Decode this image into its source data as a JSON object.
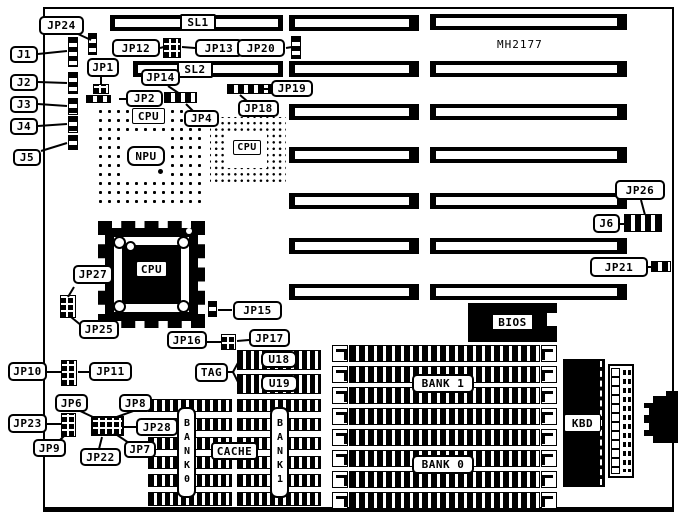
{
  "board": {
    "model": "MH2177"
  },
  "slots": {
    "sl1": "SL1",
    "sl2": "SL2"
  },
  "connectors": {
    "j1": "J1",
    "j2": "J2",
    "j3": "J3",
    "j4": "J4",
    "j5": "J5",
    "j6": "J6"
  },
  "jumpers": {
    "jp1": "JP1",
    "jp2": "JP2",
    "jp4": "JP4",
    "jp6": "JP6",
    "jp7": "JP7",
    "jp8": "JP8",
    "jp9": "JP9",
    "jp10": "JP10",
    "jp11": "JP11",
    "jp12": "JP12",
    "jp13": "JP13",
    "jp14": "JP14",
    "jp15": "JP15",
    "jp16": "JP16",
    "jp17": "JP17",
    "jp18": "JP18",
    "jp19": "JP19",
    "jp20": "JP20",
    "jp21": "JP21",
    "jp22": "JP22",
    "jp23": "JP23",
    "jp24": "JP24",
    "jp25": "JP25",
    "jp26": "JP26",
    "jp27": "JP27",
    "jp28": "JP28"
  },
  "chips": {
    "cpu_socket_label": "CPU",
    "npu_label": "NPU",
    "cpu_qfp_label": "CPU",
    "cpu_pga_label": "CPU",
    "bios_label": "BIOS",
    "kbd_label": "KBD",
    "tag_label": "TAG",
    "cache_label": "CACHE",
    "u18_label": "U18",
    "u19_label": "U19"
  },
  "memory": {
    "bank0_simm_label": "BANK 0",
    "bank1_simm_label": "BANK 1",
    "bank0_cache_label": "BANK0",
    "bank1_cache_label": "BANK1"
  },
  "colors": {
    "ink": "#000000",
    "paper": "#ffffff"
  }
}
